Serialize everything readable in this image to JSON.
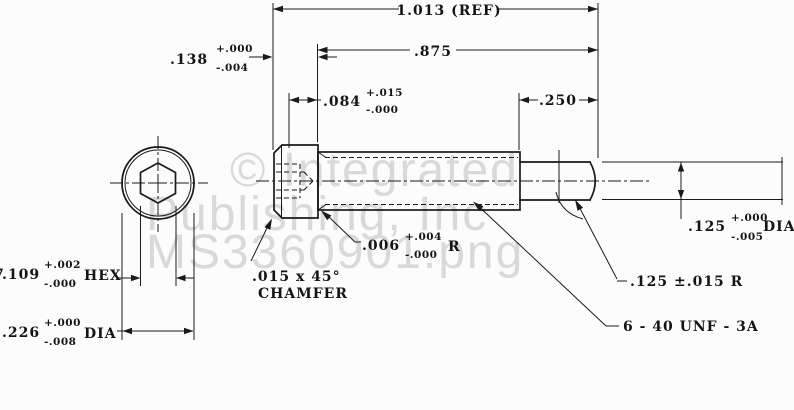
{
  "drawing": {
    "type": "mil-spec socket head cap screw dimensioned drawing",
    "colors": {
      "line": "#1a1a1a",
      "background": "#fcfcfc",
      "watermark": "#d9d9d9"
    },
    "watermark": {
      "line1": "© Integrated",
      "line2": "Publishing, Inc",
      "line3": "MS3360901.png"
    },
    "dimensions": {
      "overall_length_ref": "1.013 (REF)",
      "shank_length": ".875",
      "head_height": {
        "value": ".138",
        "plus": "+.000",
        "minus": "-.004"
      },
      "socket_depth": {
        "value": ".084",
        "plus": "+.015",
        "minus": "-.000"
      },
      "pilot_length": ".250",
      "pilot_diameter": {
        "value": ".125",
        "plus": "+.000",
        "minus": "-.005",
        "suffix": "DIA"
      },
      "underhead_radius": {
        "value": ".006",
        "plus": "+.004",
        "minus": "-.000",
        "suffix": "R"
      },
      "chamfer_note": {
        "line1": ".015 x 45°",
        "line2": "CHAMFER"
      },
      "hex_socket": {
        "edge_fragment": "7",
        "value": ".109",
        "plus": "+.002",
        "minus": "-.000",
        "suffix": "HEX"
      },
      "head_diameter": {
        "value": ".226",
        "plus": "+.000",
        "minus": "-.008",
        "suffix": "DIA"
      },
      "tip_radius": ".125 ±.015 R",
      "thread_spec": "6 - 40 UNF - 3A"
    }
  }
}
